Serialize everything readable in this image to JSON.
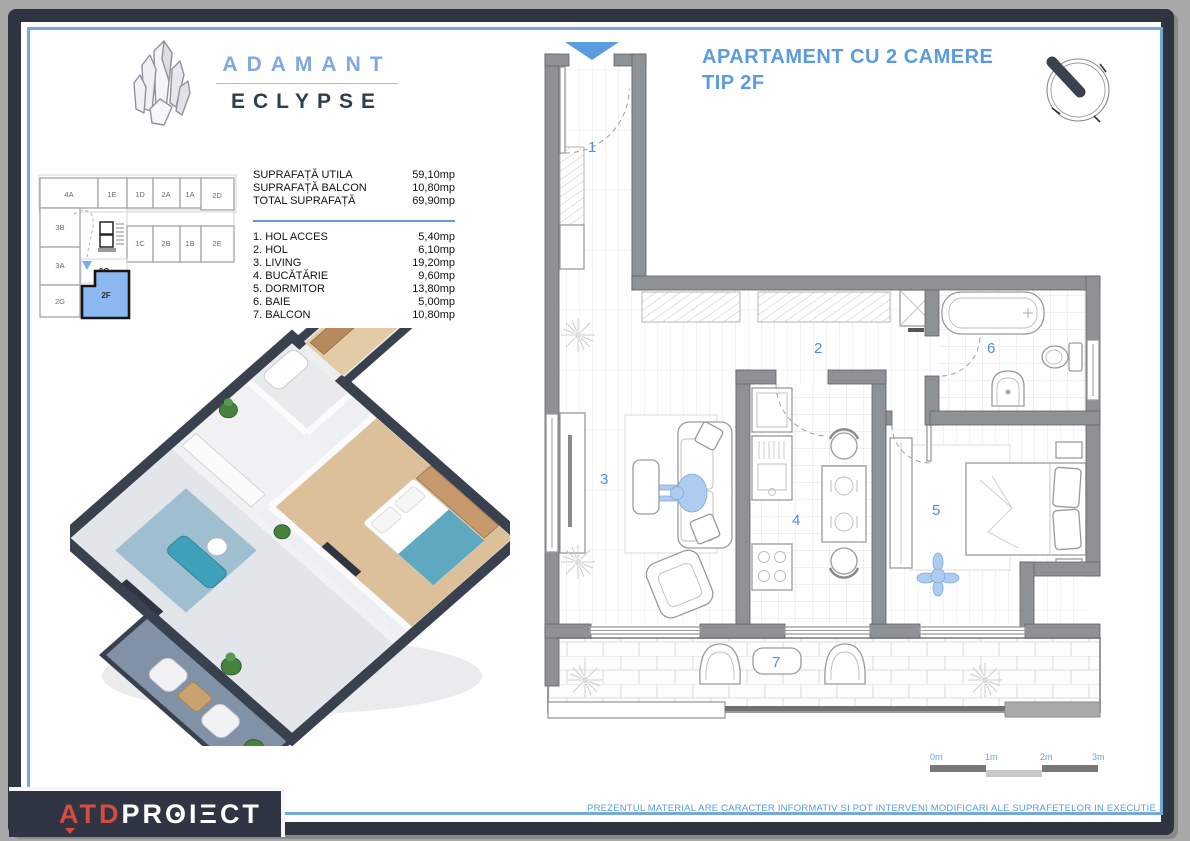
{
  "logo": {
    "brand_top": "ADAMANT",
    "brand_bottom": "ECLYPSE"
  },
  "title": {
    "line1": "APARTAMENT CU 2 CAMERE",
    "line2": "TIP 2F"
  },
  "areas": {
    "summary": [
      {
        "label": "SUPRAFAȚĂ UTILA",
        "value": "59,10mp"
      },
      {
        "label": "SUPRAFAȚĂ BALCON",
        "value": "10,80mp"
      },
      {
        "label": "TOTAL SUPRAFAȚĂ",
        "value": "69,90mp"
      }
    ],
    "rooms": [
      {
        "label": "1. HOL ACCES",
        "value": "5,40mp"
      },
      {
        "label": "2. HOL",
        "value": "6,10mp"
      },
      {
        "label": "3. LIVING",
        "value": "19,20mp"
      },
      {
        "label": "4. BUCĂTĂRIE",
        "value": "9,60mp"
      },
      {
        "label": "5. DORMITOR",
        "value": "13,80mp"
      },
      {
        "label": "6. BAIE",
        "value": "5,00mp"
      },
      {
        "label": "7. BALCON",
        "value": "10,80mp"
      }
    ]
  },
  "key_plan": {
    "units": [
      "4A",
      "1E",
      "1D",
      "2A",
      "1A",
      "2D",
      "3B",
      "1C",
      "2B",
      "1B",
      "2E",
      "3A",
      "2C",
      "2G",
      "2F"
    ],
    "highlighted_unit": "2F"
  },
  "floor_plan": {
    "room_numbers": [
      "1",
      "2",
      "3",
      "4",
      "5",
      "6",
      "7"
    ]
  },
  "scale_bar": {
    "labels": [
      "0m",
      "1m",
      "2m",
      "3m"
    ]
  },
  "footer": {
    "brand_red": "ATD",
    "brand_white_parts": [
      "PR",
      "O",
      "I",
      "Ξ",
      "CT"
    ],
    "disclaimer": "PREZENTUL MATERIAL ARE CARACTER INFORMATIV SI POT INTERVENI MODIFICARI ALE SUPRAFETELOR IN EXECUTIE"
  },
  "colors": {
    "accent_blue": "#5b9ce0",
    "room_number_blue": "#4a90e2",
    "highlight_unit_blue": "#8cb8f2",
    "wall_gray": "#8f9295",
    "frame_navy": "#2e3440",
    "logo_red": "#d84b40"
  }
}
